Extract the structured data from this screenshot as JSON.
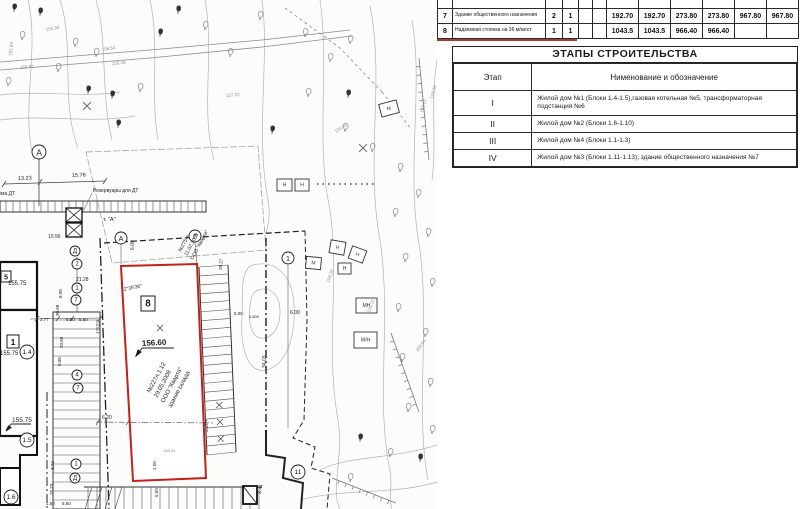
{
  "colors": {
    "parcel_red": "#c2201a",
    "underline_red": "#a83a30",
    "draw_black": "#1c1c1c",
    "draw_gray": "#8f8f8f"
  },
  "top_table": {
    "rows": [
      {
        "num": "6",
        "desc": "Надз. площадка (суд)",
        "c1": "1",
        "c2": "1",
        "values": [
          "84.60",
          "84.60",
          "",
          "",
          "",
          ""
        ]
      },
      {
        "num": "7",
        "desc": "Здание общественного назначения",
        "c1": "2",
        "c2": "1",
        "values": [
          "192.70",
          "192.70",
          "273.80",
          "273.80",
          "967.80",
          "967.80"
        ]
      },
      {
        "num": "8",
        "desc": "Надземная стоянка на 36 м/мест",
        "c1": "1",
        "c2": "1",
        "values": [
          "1043.5",
          "1043.5",
          "966.40",
          "966.40",
          "",
          ""
        ]
      }
    ]
  },
  "stages_table": {
    "title": "ЭТАПЫ СТРОИТЕЛЬСТВА",
    "headers": [
      "Этап",
      "Нименование и обозначение"
    ],
    "rows": [
      {
        "stage": "I",
        "desc": "Жилой дом №1 (Блоки 1.4-1.5),газовая котельная №5, трансформаторная подстанция №6"
      },
      {
        "stage": "II",
        "desc": "Жилой дом №2 (Блоки 1.6-1.10)"
      },
      {
        "stage": "III",
        "desc": "Жилой дом №4 (Блоки 1.1-1.3)"
      },
      {
        "stage": "IV",
        "desc": "Жилой дом №3 (Блоки 1.11-1.13), здание общественного назначения №7"
      }
    ]
  },
  "map": {
    "labels": [
      {
        "t": "13.23",
        "x": 18,
        "y": 180,
        "r": -2,
        "s": 5.5
      },
      {
        "t": "15.76",
        "x": 72,
        "y": 177,
        "r": -2,
        "s": 5.5
      },
      {
        "t": "Резервуары для ДТ",
        "x": 93,
        "y": 192,
        "r": 0,
        "s": 5
      },
      {
        "t": "приёма ДТ",
        "x": -10,
        "y": 195,
        "r": 0,
        "s": 5
      },
      {
        "t": "т. \"А\"",
        "x": 103,
        "y": 221,
        "r": 0,
        "s": 5.5
      },
      {
        "t": "10.56",
        "x": 48,
        "y": 238,
        "r": 0,
        "s": 5
      },
      {
        "t": "155.99",
        "x": 46,
        "y": 31,
        "r": -10,
        "s": 4.5,
        "c": "g"
      },
      {
        "t": "156.54",
        "x": 102,
        "y": 51,
        "r": -8,
        "s": 4.5,
        "c": "g"
      },
      {
        "t": "156.49",
        "x": 112,
        "y": 65,
        "r": -5,
        "s": 4.5,
        "c": "g"
      },
      {
        "t": "155.92",
        "x": 20,
        "y": 69,
        "r": -5,
        "s": 4.5,
        "c": "g"
      },
      {
        "t": "155.84",
        "x": 12,
        "y": 56,
        "r": -85,
        "s": 4.5,
        "c": "g"
      },
      {
        "t": "157.22",
        "x": 226,
        "y": 97,
        "r": -5,
        "s": 4.5,
        "c": "g"
      },
      {
        "t": "158.02",
        "x": 336,
        "y": 133,
        "r": -35,
        "s": 4.5,
        "c": "g"
      },
      {
        "t": "158.22",
        "x": 423,
        "y": 113,
        "r": -75,
        "s": 4.5,
        "c": "g"
      },
      {
        "t": "158.34",
        "x": 433,
        "y": 99,
        "r": -75,
        "s": 4.5,
        "c": "g"
      },
      {
        "t": "159.25",
        "x": 370,
        "y": 313,
        "r": -70,
        "s": 4.5,
        "c": "g"
      },
      {
        "t": "158.25",
        "x": 329,
        "y": 283,
        "r": -70,
        "s": 4.5,
        "c": "g"
      },
      {
        "t": "158.64",
        "x": 418,
        "y": 352,
        "r": -55,
        "s": 4.5,
        "c": "g"
      },
      {
        "t": "155.75",
        "x": 8,
        "y": 285,
        "r": 0,
        "s": 6
      },
      {
        "t": "155.75",
        "x": 0,
        "y": 355,
        "r": 0,
        "s": 6
      },
      {
        "t": "155.75",
        "x": 12,
        "y": 422,
        "r": 0,
        "s": 6.5
      },
      {
        "t": "156.60",
        "x": 142,
        "y": 346,
        "r": -3,
        "s": 8,
        "w": 1
      },
      {
        "t": "№227л.1.12",
        "x": 150,
        "y": 393,
        "r": -62,
        "s": 6
      },
      {
        "t": "29.05.2008",
        "x": 157,
        "y": 398,
        "r": -62,
        "s": 6
      },
      {
        "t": "ООО \"Кварта\"",
        "x": 164,
        "y": 403,
        "r": -62,
        "s": 6
      },
      {
        "t": "здание склада",
        "x": 171,
        "y": 408,
        "r": -62,
        "s": 6
      },
      {
        "t": "2°35'36\"",
        "x": 124,
        "y": 291,
        "r": -12,
        "s": 5
      },
      {
        "t": "1°6'23\"",
        "x": 99,
        "y": 334,
        "r": -87,
        "s": 4.5
      },
      {
        "t": "№275-в",
        "x": 181,
        "y": 252,
        "r": -62,
        "s": 5
      },
      {
        "t": "11.02.2009",
        "x": 187,
        "y": 256,
        "r": -62,
        "s": 5
      },
      {
        "t": "ООО \"Кварта\"",
        "x": 193,
        "y": 260,
        "r": -62,
        "s": 5
      },
      {
        "t": "158.94",
        "x": 163,
        "y": 452,
        "r": 0,
        "s": 4,
        "c": "g"
      },
      {
        "t": "1.50",
        "x": 156,
        "y": 470,
        "r": -90,
        "s": 4.5
      },
      {
        "t": "6.20",
        "x": 102,
        "y": 419,
        "r": 0,
        "s": 5
      },
      {
        "t": "9.20",
        "x": 208,
        "y": 432,
        "r": -90,
        "s": 5
      },
      {
        "t": "8.41",
        "x": 261,
        "y": 494,
        "r": -82,
        "s": 5
      },
      {
        "t": "6.00",
        "x": 134,
        "y": 250,
        "r": -90,
        "s": 5
      },
      {
        "t": "6.00",
        "x": 290,
        "y": 314,
        "r": 0,
        "s": 5
      },
      {
        "t": "6.00",
        "x": 234,
        "y": 315,
        "r": 0,
        "s": 4.5
      },
      {
        "t": "0.600",
        "x": 249,
        "y": 318,
        "r": 0,
        "s": 4
      },
      {
        "t": "34.03",
        "x": 266,
        "y": 368,
        "r": -90,
        "s": 5
      },
      {
        "t": "28.27",
        "x": 222,
        "y": 270,
        "r": -87,
        "s": 4.5
      },
      {
        "t": "21.28",
        "x": 76,
        "y": 281,
        "r": 0,
        "s": 5
      },
      {
        "t": "8.00",
        "x": 62,
        "y": 298,
        "r": -90,
        "s": 4.5
      },
      {
        "t": "30.68",
        "x": 59,
        "y": 316,
        "r": -90,
        "s": 4.5
      },
      {
        "t": "20.60",
        "x": 63,
        "y": 348,
        "r": -90,
        "s": 4.5
      },
      {
        "t": "0.38",
        "x": 61,
        "y": 366,
        "r": -90,
        "s": 4.5
      },
      {
        "t": "3.77",
        "x": 40,
        "y": 321,
        "r": 0,
        "s": 4.5
      },
      {
        "t": "6.00",
        "x": 66,
        "y": 321,
        "r": 0,
        "s": 4.5
      },
      {
        "t": "5.50",
        "x": 79,
        "y": 321,
        "r": 0,
        "s": 4.5
      },
      {
        "t": "3.72",
        "x": 54,
        "y": 470,
        "r": -90,
        "s": 4.5
      },
      {
        "t": "15.23",
        "x": 53,
        "y": 495,
        "r": -90,
        "s": 4.5
      },
      {
        "t": "1.50",
        "x": 46,
        "y": 505,
        "r": 0,
        "s": 4.5
      },
      {
        "t": "5.50",
        "x": 62,
        "y": 505,
        "r": 0,
        "s": 4.5
      },
      {
        "t": "5.50",
        "x": 158,
        "y": 497,
        "r": -90,
        "s": 4.5
      }
    ],
    "markers": [
      {
        "t": "А",
        "x": 39,
        "y": 152,
        "rr": 7
      },
      {
        "t": "А",
        "x": 121,
        "y": 238,
        "rr": 6
      },
      {
        "t": "Г",
        "x": 195,
        "y": 236,
        "rr": 6
      },
      {
        "t": "Д",
        "x": 75,
        "y": 251,
        "rr": 5
      },
      {
        "t": "2",
        "x": 77,
        "y": 264,
        "rr": 5
      },
      {
        "t": "1",
        "x": 77,
        "y": 288,
        "rr": 5
      },
      {
        "t": "7",
        "x": 76,
        "y": 300,
        "rr": 5
      },
      {
        "t": "4",
        "x": 77,
        "y": 375,
        "rr": 5
      },
      {
        "t": "7",
        "x": 78,
        "y": 388,
        "rr": 5
      },
      {
        "t": "1",
        "x": 76,
        "y": 464,
        "rr": 5
      },
      {
        "t": "Д",
        "x": 75,
        "y": 478,
        "rr": 5
      },
      {
        "t": "1",
        "x": 288,
        "y": 258,
        "rr": 6
      },
      {
        "t": "11",
        "x": 298,
        "y": 472,
        "rr": 7
      },
      {
        "t": "1.4",
        "x": 27,
        "y": 352,
        "rr": 7
      },
      {
        "t": "1.5",
        "x": 27,
        "y": 440,
        "rr": 7
      },
      {
        "t": "1.6",
        "x": 11,
        "y": 497,
        "rr": 7
      }
    ],
    "boxes": [
      {
        "t": "5",
        "x": 1,
        "y": 271,
        "w": 10,
        "h": 11
      },
      {
        "t": "1",
        "x": 7,
        "y": 335,
        "w": 12,
        "h": 13
      },
      {
        "t": "8",
        "x": 141,
        "y": 296,
        "w": 14,
        "h": 15
      }
    ],
    "sheds": [
      {
        "t": "Н",
        "x": 277,
        "y": 179,
        "w": 15,
        "h": 12,
        "r": 0
      },
      {
        "t": "Н",
        "x": 295,
        "y": 179,
        "w": 14,
        "h": 12,
        "r": 0
      },
      {
        "t": "М",
        "x": 380,
        "y": 102,
        "w": 18,
        "h": 13,
        "r": -15
      },
      {
        "t": "М",
        "x": 306,
        "y": 257,
        "w": 15,
        "h": 12,
        "r": 5
      },
      {
        "t": "Н",
        "x": 330,
        "y": 241,
        "w": 15,
        "h": 13,
        "r": 10
      },
      {
        "t": "Н",
        "x": 350,
        "y": 248,
        "w": 15,
        "h": 13,
        "r": 20
      },
      {
        "t": "Н",
        "x": 338,
        "y": 263,
        "w": 13,
        "h": 11,
        "r": 0
      },
      {
        "t": "МН",
        "x": 356,
        "y": 298,
        "w": 21,
        "h": 15,
        "r": 0
      },
      {
        "t": "М/Н",
        "x": 354,
        "y": 332,
        "w": 23,
        "h": 16,
        "r": 0
      }
    ]
  }
}
